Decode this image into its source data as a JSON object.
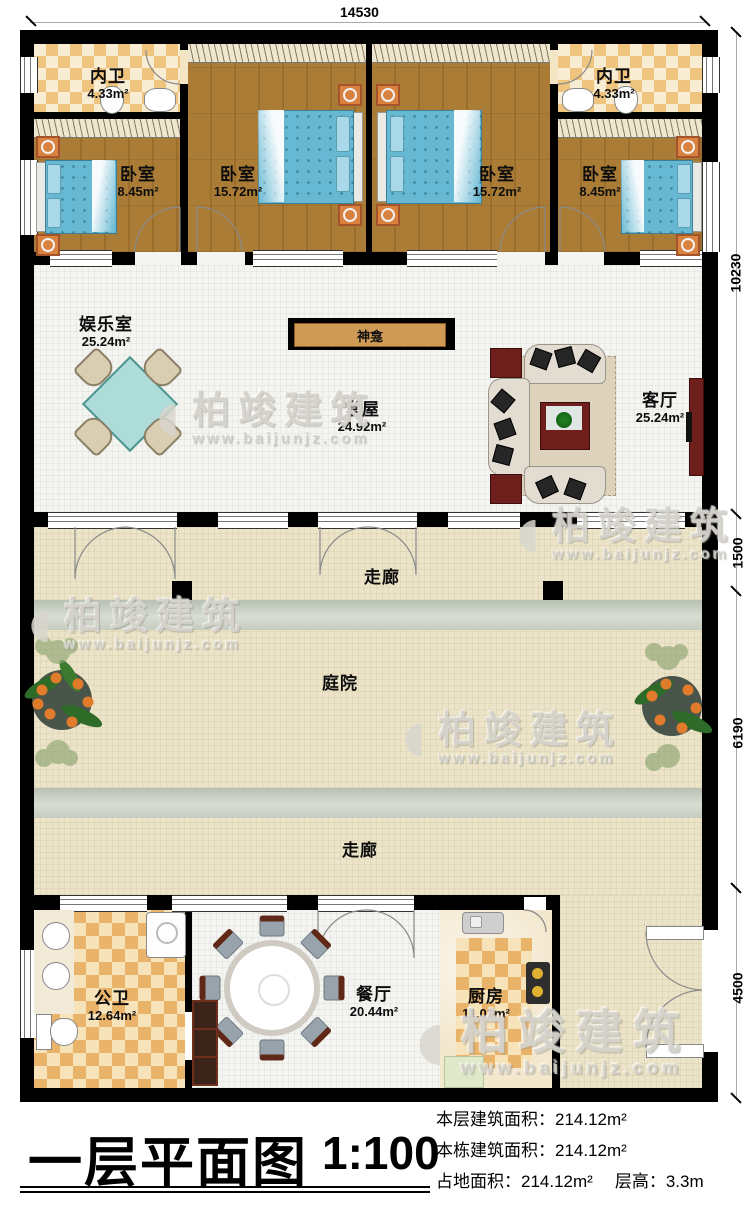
{
  "watermark": {
    "cn": "柏竣建筑",
    "url": "www.baijunjz.com"
  },
  "dimensions": {
    "top": "14530",
    "right_top": "10230",
    "right_corridor": "1500",
    "right_courtyard": "6190",
    "right_bottom": "4500"
  },
  "rooms": {
    "neiwei_left": {
      "name": "内卫",
      "area": "4.33m²"
    },
    "neiwei_right": {
      "name": "内卫",
      "area": "4.33m²"
    },
    "bedroom_small_left": {
      "name": "卧室",
      "area": "8.45m²"
    },
    "bedroom_large_left": {
      "name": "卧室",
      "area": "15.72m²"
    },
    "bedroom_large_right": {
      "name": "卧室",
      "area": "15.72m²"
    },
    "bedroom_small_right": {
      "name": "卧室",
      "area": "8.45m²"
    },
    "yuleshi": {
      "name": "娱乐室",
      "area": "25.24m²"
    },
    "shenkan": {
      "name": "神龛"
    },
    "tangwu": {
      "name": "堂屋",
      "area": "24.92m²"
    },
    "keting": {
      "name": "客厅",
      "area": "25.24m²"
    },
    "zoulang_top": {
      "name": "走廊"
    },
    "tingyuan": {
      "name": "庭院"
    },
    "zoulang_bottom": {
      "name": "走廊"
    },
    "gongwei": {
      "name": "公卫",
      "area": "12.64m²"
    },
    "canting": {
      "name": "餐厅",
      "area": "20.44m²"
    },
    "chufang": {
      "name": "厨房",
      "area": "11.01m²"
    }
  },
  "titleblock": {
    "title": "一层平面图",
    "scale": "1:100",
    "stats": [
      {
        "label": "本层建筑面积：",
        "value": "214.12m²"
      },
      {
        "label": "本栋建筑面积：",
        "value": "214.12m²"
      },
      {
        "label": "占地面积：",
        "value": "214.12m²"
      },
      {
        "label": "层高：",
        "value": "3.3m"
      }
    ]
  },
  "palette": {
    "wall": "#000000",
    "wood_floor": "#aa7c36",
    "bath_tile": "#eec47f",
    "wc_tile": "#e9b46a",
    "hall_floor": "#f4f4f1",
    "courtyard_floor": "#ece4c8",
    "bed_blue": "#67b9d3",
    "accent_red": "#6e1f1c",
    "shrine_tan": "#cf9a55"
  }
}
